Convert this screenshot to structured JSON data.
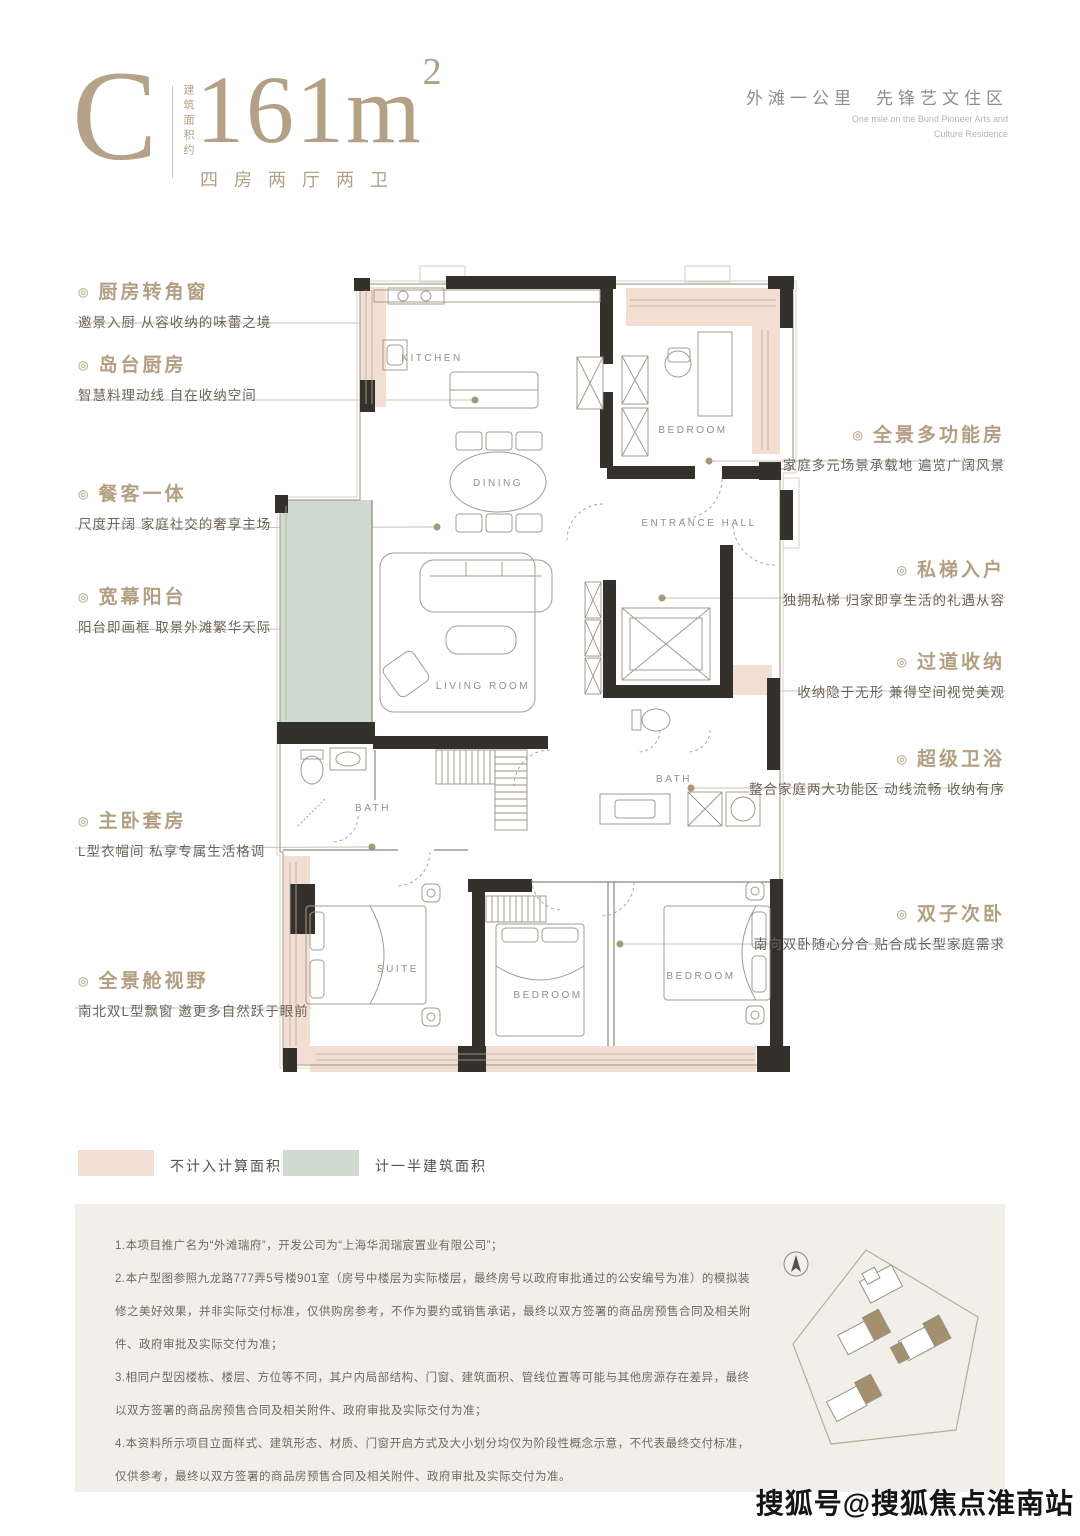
{
  "header": {
    "type_letter": "C",
    "area_label_vertical": "建筑面积约",
    "area_value": "161m",
    "area_sup": "2",
    "layout_text": "四房两厅两卫",
    "tagline_cn_1": "外滩一公里",
    "tagline_cn_2": "先锋艺文住区",
    "tagline_en_line1": "One mile on the Bund Pioneer Arts and",
    "tagline_en_line2": "Culture Residence"
  },
  "plan": {
    "rooms": {
      "kitchen": "KITCHEN",
      "dining": "DINING",
      "living": "LIVING ROOM",
      "bedroom_top": "BEDROOM",
      "entrance": "ENTRANCE HALL",
      "bath_left": "BATH",
      "bath_right": "BATH",
      "suite": "SUITE",
      "bedroom_mid": "BEDROOM",
      "bedroom_right": "BEDROOM"
    }
  },
  "notes_left": [
    {
      "title": "厨房转角窗",
      "desc": "邀景入厨 从容收纳的味蕾之境"
    },
    {
      "title": "岛台厨房",
      "desc": "智慧料理动线 自在收纳空间"
    },
    {
      "title": "餐客一体",
      "desc": "尺度开阔 家庭社交的奢享主场"
    },
    {
      "title": "宽幕阳台",
      "desc": "阳台即画框 取景外滩繁华天际"
    },
    {
      "title": "主卧套房",
      "desc": "L型衣帽间 私享专属生活格调"
    },
    {
      "title": "全景舱视野",
      "desc": "南北双L型飘窗 邀更多自然跃于眼前"
    }
  ],
  "notes_right": [
    {
      "title": "全景多功能房",
      "desc": "家庭多元场景承载地 遍览广阔风景"
    },
    {
      "title": "私梯入户",
      "desc": "独拥私梯 归家即享生活的礼遇从容"
    },
    {
      "title": "过道收纳",
      "desc": "收纳隐于无形 兼得空间视觉美观"
    },
    {
      "title": "超级卫浴",
      "desc": "整合家庭两大功能区 动线流畅 收纳有序"
    },
    {
      "title": "双子次卧",
      "desc": "南向双卧随心分合 贴合成长型家庭需求"
    }
  ],
  "legend": [
    {
      "label": "不计入计算面积",
      "color": "#f3ded3"
    },
    {
      "label": "计一半建筑面积",
      "color": "#cfdbce"
    }
  ],
  "disclaimer": {
    "items": [
      "1.本项目推广名为“外滩瑞府”，开发公司为“上海华润瑞宸置业有限公司”；",
      "2.本户型图参照九龙路777弄5号楼901室（房号中楼层为实际楼层，最终房号以政府审批通过的公安编号为准）的模拟装修之美好效果，并非实际交付标准，仅供购房参考，不作为要约或销售承诺，最终以双方签署的商品房预售合同及相关附件、政府审批及实际交付为准；",
      "3.相同户型因楼栋、楼层、方位等不同，其户内局部结构、门窗、建筑面积、管线位置等可能与其他房源存在差异，最终以双方签署的商品房预售合同及相关附件、政府审批及实际交付为准；",
      "4.本资料所示项目立面样式、建筑形态、材质、门窗开启方式及大小划分均仅为阶段性概念示意，不代表最终交付标准，仅供参考，最终以双方签署的商品房预售合同及相关附件、政府审批及实际交付为准。"
    ]
  },
  "watermark": "搜狐号@搜狐焦点淮南站",
  "colors": {
    "accent_gold": "#b3a085",
    "note_desc": "#6d6359",
    "pink_area": "#f3ded3",
    "green_area": "#cfdbce",
    "wall_black": "#34302b",
    "tagline_gray": "#8e8e8e"
  }
}
